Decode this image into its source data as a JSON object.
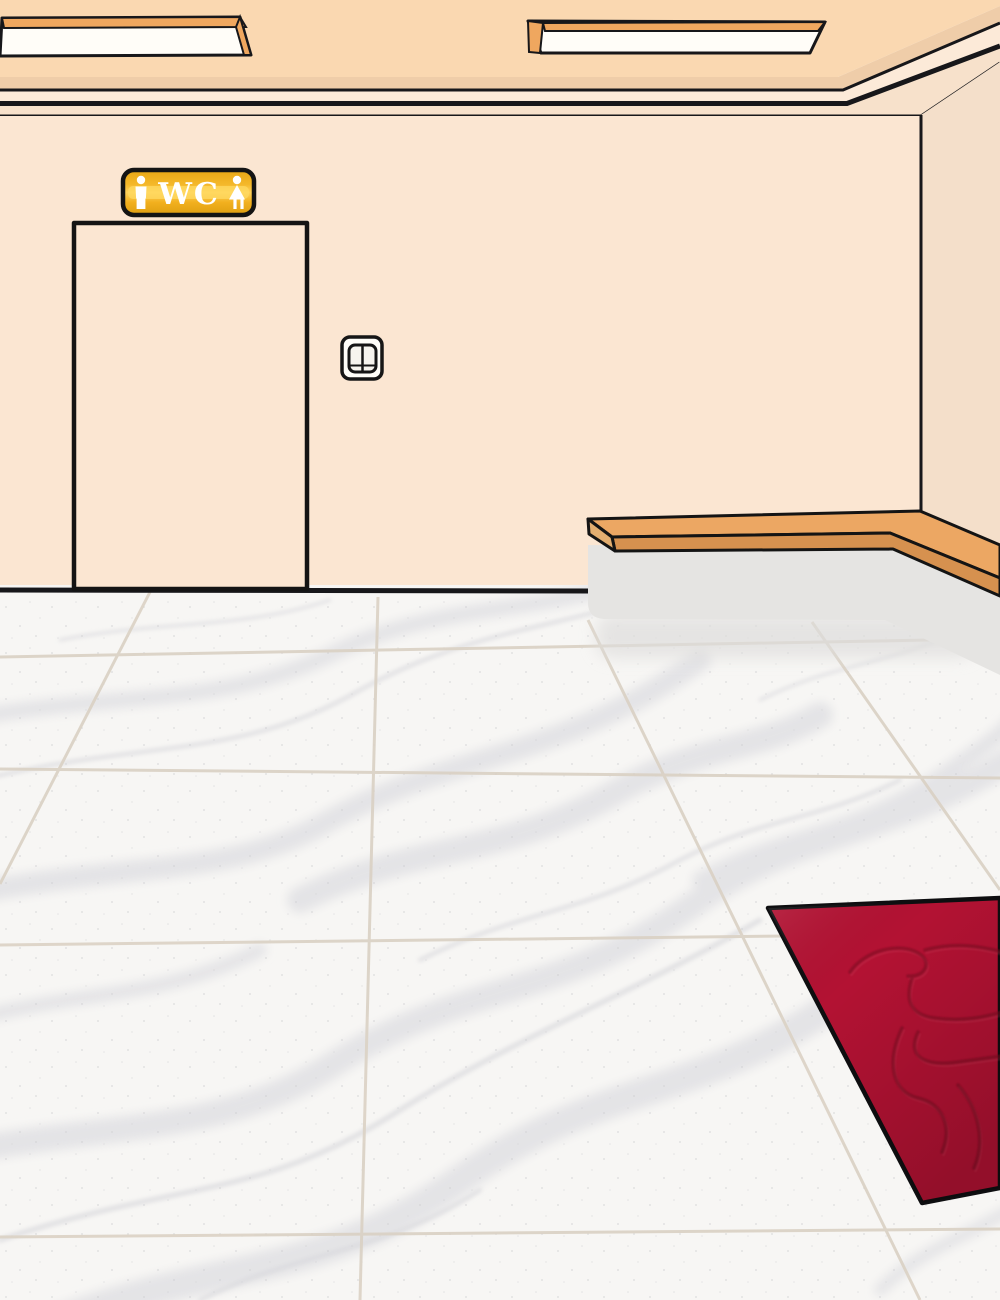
{
  "scene": {
    "label": "Illustrated hallway interior with WC door, wooden ledge, marble floor and red carpet"
  },
  "wc_sign": {
    "label": "WC"
  },
  "objects": [
    "ceiling-light-left",
    "ceiling-light-right",
    "wc-sign",
    "toilet-door",
    "light-switch",
    "wooden-ledge",
    "base-panel",
    "marble-floor",
    "red-carpet"
  ],
  "colors": {
    "ceiling": "#FAD8B1",
    "ceiling_edge": "#EFCDA9",
    "molding_light": "#FCEAD8",
    "molding_lower": "#F7E1CB",
    "back_wall": "#FBE6D2",
    "right_wall": "#F4DFCA",
    "outline": "#17171A",
    "floor": "#F7F6F4",
    "grout": "#DAD1C4",
    "base_panel": "#E5E4E2",
    "wood_top": "#ECA763",
    "wood_front": "#D6914F",
    "wood_end": "#E3AE70",
    "lamp_panel": "#FFFDF8",
    "lamp_trim": "#EFA75F",
    "carpet": "#B31233",
    "carpet_emboss": "#7C0A20",
    "sign_gold": "#F2B01E",
    "sign_gold_light": "#FFD25B",
    "sign_text": "#FFFFFF"
  }
}
